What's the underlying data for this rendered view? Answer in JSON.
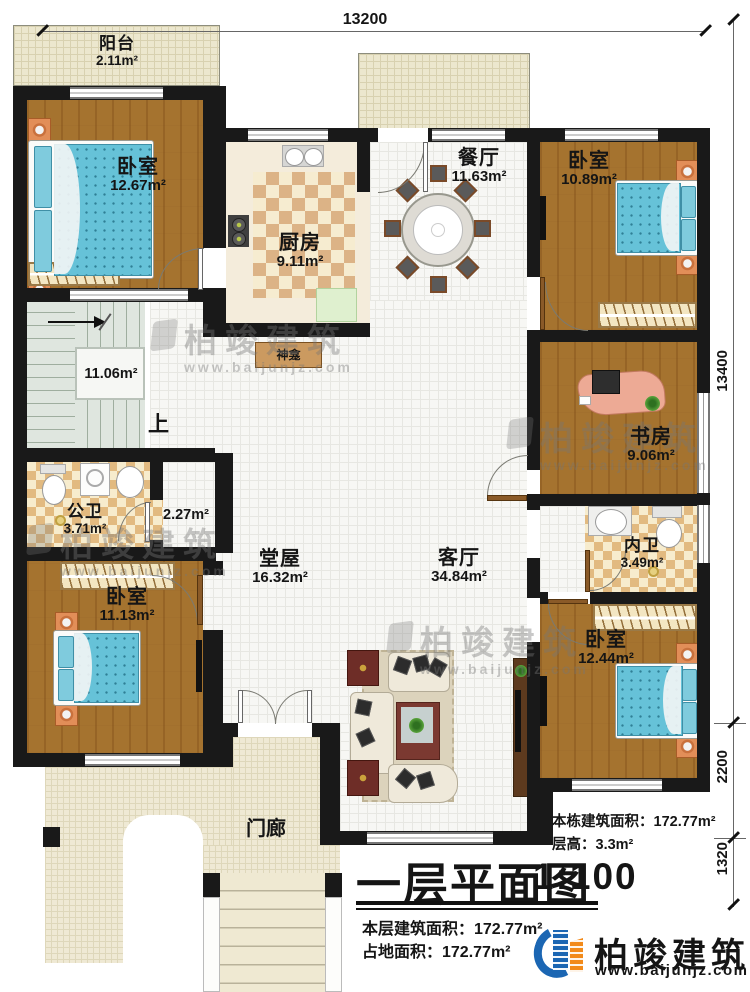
{
  "dimensions": {
    "top": "13200",
    "right_upper": "13400",
    "right_middle": "2200",
    "right_lower": "1320"
  },
  "rooms": {
    "balcony": {
      "name": "阳台",
      "area": "2.11m²"
    },
    "bedroom_top_left": {
      "name": "卧室",
      "area": "12.67m²"
    },
    "kitchen": {
      "name": "厨房",
      "area": "9.11m²"
    },
    "dining": {
      "name": "餐厅",
      "area": "11.63m²"
    },
    "bedroom_top_right": {
      "name": "卧室",
      "area": "10.89m²"
    },
    "stairwell": {
      "area": "11.06m²",
      "up": "上"
    },
    "shrine": {
      "name": "神龛"
    },
    "study": {
      "name": "书房",
      "area": "9.06m²"
    },
    "public_bathroom": {
      "name": "公卫",
      "area": "3.71m²"
    },
    "corridor": {
      "area": "2.27m²"
    },
    "hall": {
      "name": "堂屋",
      "area": "16.32m²"
    },
    "living_room": {
      "name": "客厅",
      "area": "34.84m²"
    },
    "ensuite_bathroom": {
      "name": "内卫",
      "area": "3.49m²"
    },
    "bedroom_bottom_left": {
      "name": "卧室",
      "area": "11.13m²"
    },
    "bedroom_bottom_right": {
      "name": "卧室",
      "area": "12.44m²"
    },
    "porch": {
      "name": "门廊"
    }
  },
  "title_block": {
    "title": "一层平面图",
    "scale": "1:100",
    "floor_area": "本层建筑面积：172.77m²",
    "footprint_area": "占地面积：172.77m²"
  },
  "building_info": {
    "total_area": "本栋建筑面积：172.77m²",
    "floor_height": "层高：3.3m²"
  },
  "logo": {
    "name": "柏竣建筑",
    "website": "www.baijunjz.com"
  },
  "watermark": {
    "text": "柏竣建筑",
    "url": "www.baijunjz.com"
  }
}
